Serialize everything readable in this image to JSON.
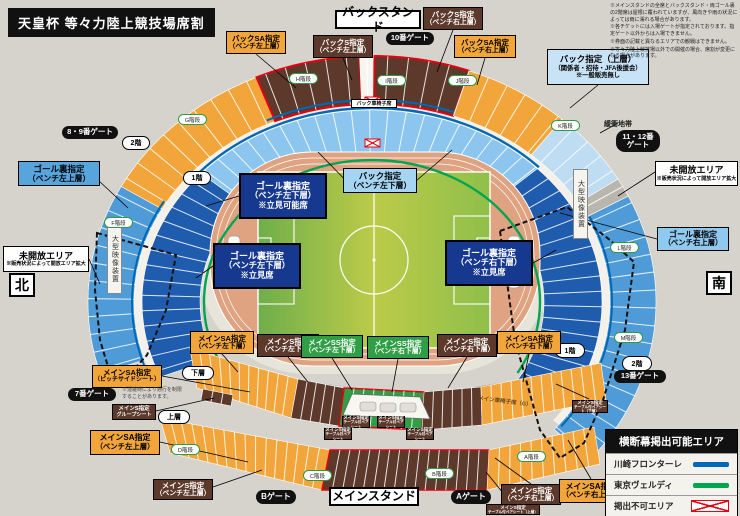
{
  "title": "天皇杯 等々力陸上競技場席割",
  "notes": [
    "※メインスタンドの全席とバックスタンド・両ゴール裏の2階席は屋根に覆われていますが、風向きや雨の状況によっては雨に濡れる場合があります。",
    "※各チケットには入場ゲートが指定されております。指定ゲート以外からは入場できません。",
    "※券面の記載と異なるエリアでの観戦はできません。",
    "※等々力陸上競技場以外での開催の場合、席割が変更になる場合があります。"
  ],
  "palette": {
    "bg": "#d6d3cc",
    "orange": "#f2a53a",
    "brown": "#5c392a",
    "green": "#2f9e44",
    "navy": "#16388f",
    "blue_mid": "#4f9bd7",
    "blue_light": "#8cc6ee",
    "blue_pale": "#bedcf2",
    "blue_dark": "#1f5cad",
    "frontale_blue": "#0068b7",
    "verdy_green": "#00a551",
    "red": "#e60012",
    "track": "#dfa381",
    "field_green": "#7ab648",
    "gray_buffer": "#b9b6ad",
    "white": "#f7f5ef"
  },
  "labels": [
    {
      "name": "label-backstand",
      "x": 335,
      "y": 10,
      "w": 86,
      "h": 19,
      "bg": "#ffffff",
      "fg": "#000",
      "fz": 12,
      "bw": 2,
      "lines": [
        "バックスタンド"
      ]
    },
    {
      "name": "label-back-sa-left-upper",
      "x": 226,
      "y": 31,
      "w": 60,
      "h": 23,
      "bg": "#f2a53a",
      "fg": "#000",
      "fz": 7.5,
      "lines": [
        "バックSA指定",
        "（ベンチ左上層）"
      ]
    },
    {
      "name": "label-back-s-left-upper",
      "x": 313,
      "y": 35,
      "w": 60,
      "h": 23,
      "bg": "#5c392a",
      "fg": "#fff",
      "fz": 7.5,
      "lines": [
        "バックS指定",
        "（ベンチ左上層）"
      ]
    },
    {
      "name": "label-back-s-right-upper",
      "x": 423,
      "y": 7,
      "w": 60,
      "h": 23,
      "bg": "#5c392a",
      "fg": "#fff",
      "fz": 7.5,
      "lines": [
        "バックS指定",
        "（ベンチ右上層）"
      ]
    },
    {
      "name": "label-back-sa-right-upper",
      "x": 454,
      "y": 35,
      "w": 62,
      "h": 23,
      "bg": "#f2a53a",
      "fg": "#000",
      "fz": 7.5,
      "lines": [
        "バックSA指定",
        "（ベンチ右上層）"
      ]
    },
    {
      "name": "label-back-upper-reserved",
      "x": 547,
      "y": 49,
      "w": 102,
      "h": 36,
      "bg": "#c8e2f6",
      "fg": "#000",
      "fz": 8.5,
      "fz2": 6.3,
      "lines": [
        "バック指定（上層）",
        "（関係者・招待・JFA後援会）",
        "※一般販売無し"
      ]
    },
    {
      "name": "label-unopened-right",
      "x": 655,
      "y": 161,
      "w": 83,
      "h": 25,
      "bg": "#ffffff",
      "fg": "#000",
      "fz": 9,
      "fz2": 5,
      "lines": [
        "未開放エリア",
        "※販売状況によって開放エリア拡大"
      ]
    },
    {
      "name": "label-goal-upper-right",
      "x": 657,
      "y": 227,
      "w": 72,
      "h": 24,
      "bg": "#8fc9f0",
      "fg": "#000",
      "fz": 8,
      "lines": [
        "ゴール裏指定",
        "（ベンチ右上層）"
      ]
    },
    {
      "name": "label-compass-south",
      "x": 706,
      "y": 271,
      "w": 26,
      "h": 24,
      "bg": "#ffffff",
      "fg": "#000",
      "fz": 14,
      "bw": 2,
      "lines": [
        "南"
      ]
    },
    {
      "name": "label-goal-upper-left",
      "x": 18,
      "y": 161,
      "w": 82,
      "h": 25,
      "bg": "#58a5de",
      "fg": "#000",
      "fz": 8.5,
      "lines": [
        "ゴール裏指定",
        "（ベンチ左上層）"
      ]
    },
    {
      "name": "label-unopened-left",
      "x": 3,
      "y": 246,
      "w": 86,
      "h": 26,
      "bg": "#ffffff",
      "fg": "#000",
      "fz": 9,
      "fz2": 5,
      "lines": [
        "未開放エリア",
        "※販売状況によって開放エリア拡大"
      ]
    },
    {
      "name": "label-compass-north",
      "x": 9,
      "y": 273,
      "w": 26,
      "h": 24,
      "bg": "#ffffff",
      "fg": "#000",
      "fz": 14,
      "bw": 2,
      "lines": [
        "北"
      ]
    },
    {
      "name": "label-goal-lower-left-a",
      "x": 239,
      "y": 173,
      "w": 88,
      "h": 46,
      "bg": "#16388f",
      "fg": "#fff",
      "fz": 9,
      "bw": 2,
      "lines": [
        "ゴール裏指定",
        "（ベンチ左下層）",
        "※立見可能席"
      ]
    },
    {
      "name": "label-back-lower",
      "x": 343,
      "y": 168,
      "w": 74,
      "h": 25,
      "bg": "#a5d5f3",
      "fg": "#000",
      "fz": 8.5,
      "lines": [
        "バック指定",
        "（ベンチ左下層）"
      ]
    },
    {
      "name": "label-goal-lower-left-b",
      "x": 213,
      "y": 243,
      "w": 88,
      "h": 46,
      "bg": "#16388f",
      "fg": "#fff",
      "fz": 9,
      "bw": 2,
      "lines": [
        "ゴール裏指定",
        "（ベンチ左下層）",
        "※立見席"
      ]
    },
    {
      "name": "label-goal-lower-right",
      "x": 445,
      "y": 240,
      "w": 88,
      "h": 46,
      "bg": "#16388f",
      "fg": "#fff",
      "fz": 9,
      "bw": 2,
      "lines": [
        "ゴール裏指定",
        "（ベンチ右下層）",
        "※立見席"
      ]
    },
    {
      "name": "label-main-sa-left-lower",
      "x": 190,
      "y": 331,
      "w": 64,
      "h": 23,
      "bg": "#f2a53a",
      "fg": "#000",
      "fz": 7.5,
      "lines": [
        "メインSA指定",
        "（ベンチ左下層）"
      ]
    },
    {
      "name": "label-main-s-left-lower",
      "x": 257,
      "y": 334,
      "w": 62,
      "h": 23,
      "bg": "#5c392a",
      "fg": "#fff",
      "fz": 7.5,
      "lines": [
        "メインS指定",
        "（ベンチ左下層）"
      ]
    },
    {
      "name": "label-main-ss-left-lower",
      "x": 301,
      "y": 335,
      "w": 62,
      "h": 23,
      "bg": "#2f9e44",
      "fg": "#fff",
      "fz": 7.5,
      "lines": [
        "メインSS指定",
        "（ベンチ左下層）"
      ]
    },
    {
      "name": "label-main-ss-right-lower",
      "x": 367,
      "y": 336,
      "w": 62,
      "h": 23,
      "bg": "#2f9e44",
      "fg": "#fff",
      "fz": 7.5,
      "lines": [
        "メインSS指定",
        "（ベンチ右下層）"
      ]
    },
    {
      "name": "label-main-s-right-lower",
      "x": 437,
      "y": 334,
      "w": 60,
      "h": 23,
      "bg": "#5c392a",
      "fg": "#fff",
      "fz": 7.5,
      "lines": [
        "メインS指定",
        "（ベンチ右下層）"
      ]
    },
    {
      "name": "label-main-sa-right-lower",
      "x": 497,
      "y": 331,
      "w": 64,
      "h": 23,
      "bg": "#f2a53a",
      "fg": "#000",
      "fz": 7.5,
      "lines": [
        "メインSA指定",
        "（ベンチ右下層）"
      ]
    },
    {
      "name": "label-main-sa-pitchside",
      "x": 92,
      "y": 365,
      "w": 70,
      "h": 23,
      "bg": "#f2a53a",
      "fg": "#000",
      "fz": 7.5,
      "fz2": 6,
      "lines": [
        "メインSA指定",
        "（ピッチサイドシート）"
      ]
    },
    {
      "name": "label-main-s-group",
      "x": 112,
      "y": 404,
      "w": 44,
      "h": 16,
      "bg": "#5c392a",
      "fg": "#fff",
      "fz": 5.5,
      "lines": [
        "メインS指定",
        "グループシート"
      ]
    },
    {
      "name": "label-main-sa-left-upper",
      "x": 90,
      "y": 430,
      "w": 70,
      "h": 25,
      "bg": "#f2a53a",
      "fg": "#000",
      "fz": 8,
      "lines": [
        "メインSA指定",
        "（ベンチ左上層）"
      ]
    },
    {
      "name": "label-main-s-left-upper",
      "x": 153,
      "y": 479,
      "w": 60,
      "h": 21,
      "bg": "#5c392a",
      "fg": "#fff",
      "fz": 7.5,
      "lines": [
        "メインS指定",
        "（ベンチ左上層）"
      ]
    },
    {
      "name": "label-main-s-right-upper",
      "x": 501,
      "y": 484,
      "w": 60,
      "h": 21,
      "bg": "#5c392a",
      "fg": "#fff",
      "fz": 7.5,
      "lines": [
        "メインS指定",
        "（ベンチ右上層）"
      ]
    },
    {
      "name": "label-main-sa-right-upper",
      "x": 559,
      "y": 479,
      "w": 64,
      "h": 24,
      "bg": "#f2a53a",
      "fg": "#000",
      "fz": 8,
      "lines": [
        "メインSA指定",
        "（ベンチ右上層）"
      ]
    },
    {
      "name": "label-mainstand",
      "x": 329,
      "y": 487,
      "w": 90,
      "h": 19,
      "bg": "#ffffff",
      "fg": "#000",
      "fz": 12,
      "bw": 2,
      "lines": [
        "メインスタンド"
      ]
    },
    {
      "name": "label-main-s-pair-1",
      "x": 342,
      "y": 416,
      "w": 28,
      "h": 12,
      "bg": "#5c392a",
      "fg": "#fff",
      "fz": 4.5,
      "fz2": 3.6,
      "lines": [
        "メインS指定",
        "テーブル付ペアシート"
      ]
    },
    {
      "name": "label-main-s-pair-2",
      "x": 377,
      "y": 416,
      "w": 28,
      "h": 12,
      "bg": "#5c392a",
      "fg": "#fff",
      "fz": 4.5,
      "fz2": 3.6,
      "lines": [
        "メインS指定",
        "テーブル付ペアシート"
      ]
    },
    {
      "name": "label-main-s-pair-3",
      "x": 324,
      "y": 428,
      "w": 28,
      "h": 12,
      "bg": "#5c392a",
      "fg": "#fff",
      "fz": 4.5,
      "fz2": 3.6,
      "lines": [
        "メインS指定",
        "テーブル付ペアシート"
      ]
    },
    {
      "name": "label-main-s-pair-4",
      "x": 406,
      "y": 428,
      "w": 28,
      "h": 12,
      "bg": "#5c392a",
      "fg": "#fff",
      "fz": 4.5,
      "fz2": 3.6,
      "lines": [
        "メインS指定",
        "テーブル付ペアシート"
      ]
    },
    {
      "name": "label-main-s-pair-lower-right",
      "x": 572,
      "y": 400,
      "w": 36,
      "h": 13,
      "bg": "#5c392a",
      "fg": "#fff",
      "fz": 4.5,
      "fz2": 3.6,
      "lines": [
        "メインS指定",
        "テーブル付ペアシート（下層）"
      ]
    },
    {
      "name": "label-main-s-pair-upper",
      "x": 486,
      "y": 504,
      "w": 54,
      "h": 11,
      "bg": "#5c392a",
      "fg": "#fff",
      "fz": 4.5,
      "fz2": 3.6,
      "lines": [
        "メインS指定",
        "テーブル付ペアシート（上層）"
      ]
    },
    {
      "name": "label-back-wheelchair",
      "x": 351,
      "y": 99,
      "w": 46,
      "h": 9,
      "bg": "#ffffff",
      "fg": "#000",
      "fz": 5,
      "lines": [
        "バック車椅子席"
      ]
    }
  ],
  "gates": [
    {
      "name": "gate-10",
      "x": 386,
      "y": 32,
      "w": 48,
      "h": 13,
      "fz": 7.5,
      "lines": [
        "10番ゲート"
      ]
    },
    {
      "name": "gate-8-9",
      "x": 62,
      "y": 126,
      "w": 56,
      "h": 13,
      "fz": 7.5,
      "lines": [
        "8・9番ゲート"
      ]
    },
    {
      "name": "gate-11-12",
      "x": 616,
      "y": 130,
      "w": 44,
      "h": 22,
      "fz": 7.5,
      "lines": [
        "11・12番",
        "ゲート"
      ]
    },
    {
      "name": "gate-13",
      "x": 614,
      "y": 370,
      "w": 52,
      "h": 13,
      "fz": 7.5,
      "lines": [
        "13番ゲート"
      ]
    },
    {
      "name": "gate-7",
      "x": 68,
      "y": 388,
      "w": 48,
      "h": 13,
      "fz": 7.5,
      "lines": [
        "7番ゲート"
      ]
    },
    {
      "name": "gate-a",
      "x": 451,
      "y": 490,
      "w": 40,
      "h": 14,
      "fz": 8,
      "lines": [
        "Aゲート"
      ]
    },
    {
      "name": "gate-b",
      "x": 256,
      "y": 490,
      "w": 40,
      "h": 14,
      "fz": 8,
      "lines": [
        "Bゲート"
      ]
    }
  ],
  "tiers": [
    {
      "name": "tier-2f-left",
      "x": 122,
      "y": 136,
      "w": 26,
      "h": 12,
      "label": "2階"
    },
    {
      "name": "tier-1f-left",
      "x": 183,
      "y": 171,
      "w": 26,
      "h": 12,
      "label": "1階"
    },
    {
      "name": "tier-1f-right",
      "x": 555,
      "y": 343,
      "w": 28,
      "h": 13,
      "label": "1階"
    },
    {
      "name": "tier-2f-right",
      "x": 622,
      "y": 356,
      "w": 28,
      "h": 13,
      "label": "2階"
    },
    {
      "name": "tier-lower",
      "x": 182,
      "y": 366,
      "w": 30,
      "h": 12,
      "label": "下層"
    },
    {
      "name": "tier-upper",
      "x": 158,
      "y": 410,
      "w": 30,
      "h": 12,
      "label": "上層"
    }
  ],
  "stairs": [
    {
      "name": "stair-g",
      "x": 178,
      "y": 114,
      "label": "G階段"
    },
    {
      "name": "stair-h",
      "x": 289,
      "y": 73,
      "label": "H階段"
    },
    {
      "name": "stair-i",
      "x": 377,
      "y": 75,
      "label": "I階段"
    },
    {
      "name": "stair-j",
      "x": 448,
      "y": 75,
      "label": "J階段"
    },
    {
      "name": "stair-k",
      "x": 551,
      "y": 120,
      "label": "K階段"
    },
    {
      "name": "stair-f",
      "x": 104,
      "y": 217,
      "label": "F階段"
    },
    {
      "name": "stair-l",
      "x": 610,
      "y": 242,
      "label": "L階段"
    },
    {
      "name": "stair-m",
      "x": 614,
      "y": 332,
      "label": "M階段"
    },
    {
      "name": "stair-d",
      "x": 171,
      "y": 444,
      "label": "D階段"
    },
    {
      "name": "stair-c",
      "x": 303,
      "y": 470,
      "label": "C階段"
    },
    {
      "name": "stair-b",
      "x": 425,
      "y": 468,
      "label": "B階段"
    },
    {
      "name": "stair-a",
      "x": 517,
      "y": 451,
      "label": "A階段"
    }
  ],
  "extras": {
    "buffer": "緩衝地帯",
    "video_board": "大型映像装置",
    "wheelchair_main": "メイン車椅子席（G）",
    "congestion": [
      "※混雑時により通行を制限",
      "することがあります。"
    ]
  },
  "legend": {
    "title": "横断幕掲出可能エリア",
    "items": [
      {
        "label": "川崎フロンターレ",
        "color": "#0068b7",
        "swatch": "line"
      },
      {
        "label": "東京ヴェルディ",
        "color": "#00a551",
        "swatch": "line"
      },
      {
        "label": "掲出不可エリア",
        "color": "#e60012",
        "swatch": "crosshatch"
      }
    ]
  }
}
